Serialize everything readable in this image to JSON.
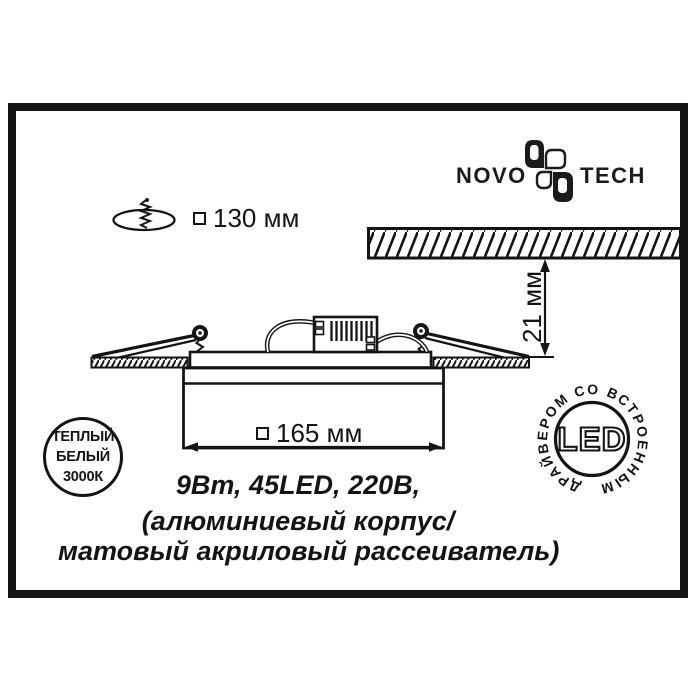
{
  "logo": {
    "part1": "NOVO",
    "part2": "TECH"
  },
  "dimensions": {
    "cutout": "130 мм",
    "visible_width": "165 мм",
    "recess_depth": "21 мм"
  },
  "specs": {
    "line1": "9Вт, 45LED, 220В,",
    "line2": "(алюминиевый корпус/",
    "line3": "матовый акриловый рассеиватель)"
  },
  "badges": {
    "warm_white": {
      "line1": "ТЕПЛЫЙ",
      "line2": "БЕЛЫЙ",
      "line3": "3000К"
    },
    "led": {
      "center": "LED",
      "ring_text": "ДРАЙВЕРОМ СО ВСТРОЕННЫМ"
    }
  },
  "colors": {
    "ink": "#141414",
    "background": "#ffffff"
  }
}
